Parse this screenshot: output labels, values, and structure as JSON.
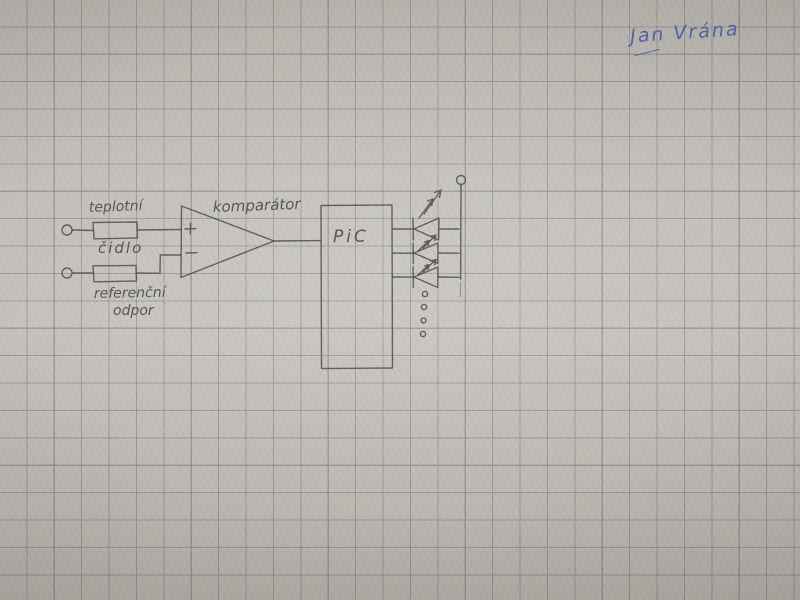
{
  "signature": {
    "text": "Jan Vrána",
    "ink_color": "#4152a2"
  },
  "schematic": {
    "labels": {
      "sensor_line1": "teplotní",
      "sensor_line2": "čidlo",
      "reference_line1": "referenční",
      "reference_line2": "odpor",
      "comparator": "komparátor",
      "plus": "+",
      "minus": "−",
      "mcu": "PiC"
    },
    "colors": {
      "pencil": "#51514d",
      "paper": "#bdbab4",
      "grid_line": "#8f9093",
      "ink_blue": "#4152a2"
    }
  }
}
